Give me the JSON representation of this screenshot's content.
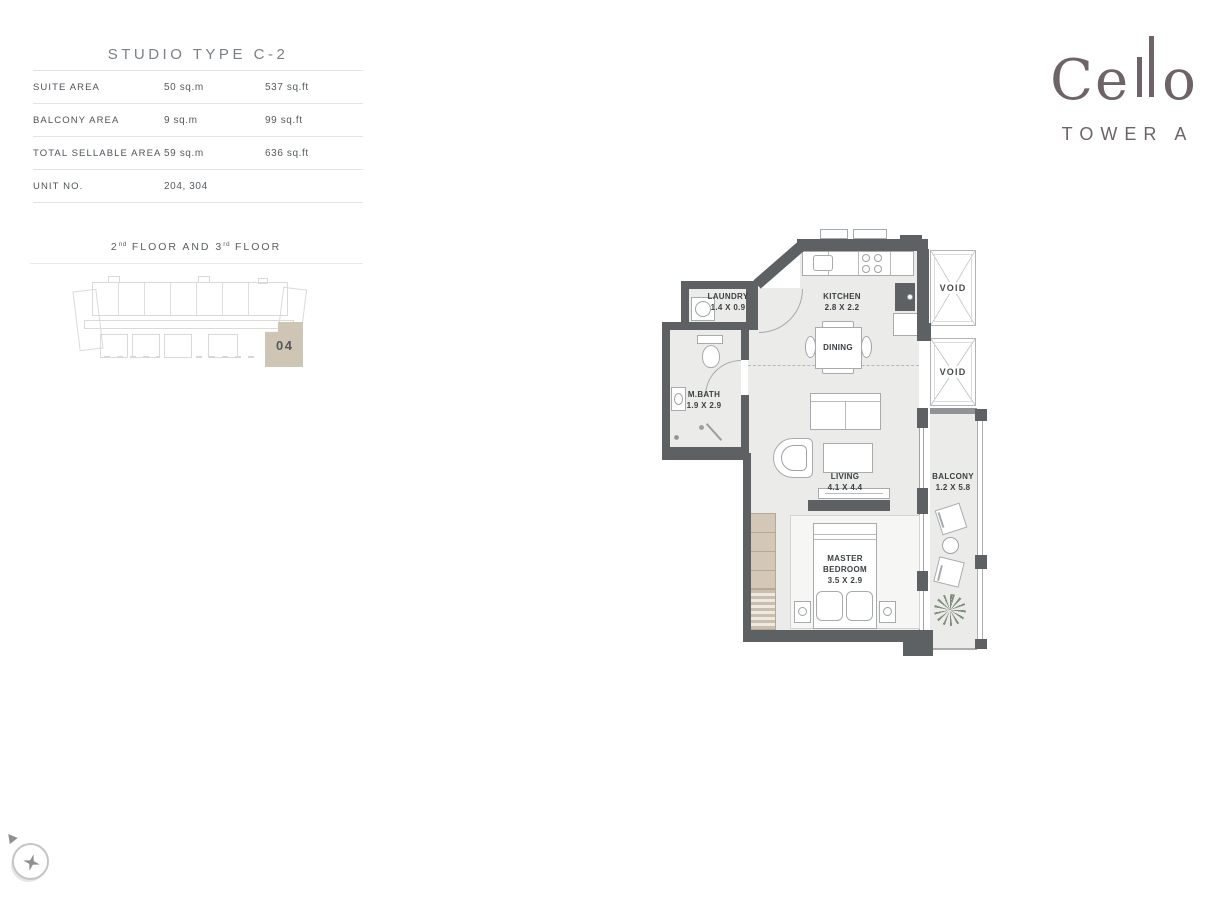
{
  "unit_info": {
    "title": "STUDIO TYPE C-2",
    "rows": [
      {
        "label": "SUITE AREA",
        "metric": "50 sq.m",
        "imperial": "537 sq.ft"
      },
      {
        "label": "BALCONY AREA",
        "metric": "9 sq.m",
        "imperial": "99 sq.ft"
      },
      {
        "label": "TOTAL SELLABLE AREA",
        "metric": "59 sq.m",
        "imperial": "636 sq.ft"
      },
      {
        "label": "UNIT NO.",
        "metric": "204, 304",
        "imperial": ""
      }
    ]
  },
  "floor_locator": {
    "label": {
      "n1": "2",
      "s1": "nd",
      "mid": " FLOOR AND 3",
      "s2": "rd",
      "end": " FLOOR"
    },
    "unit_number": "04"
  },
  "brand": {
    "logo_start": "Ce",
    "logo_end": "o",
    "tower": "TOWER A"
  },
  "floor_plan": {
    "laundry": {
      "name": "LAUNDRY",
      "dims": "1.4 X 0.9"
    },
    "kitchen": {
      "name": "KITCHEN",
      "dims": "2.8 X 2.2"
    },
    "dining": {
      "name": "DINING"
    },
    "mbath": {
      "name": "M.BATH",
      "dims": "1.9 X 2.9"
    },
    "living": {
      "name": "LIVING",
      "dims": "4.1 X 4.4"
    },
    "master": {
      "name1": "MASTER",
      "name2": "BEDROOM",
      "dims": "3.5 X 2.9"
    },
    "balcony": {
      "name": "BALCONY",
      "dims": "1.2 X 5.8"
    },
    "void_top": {
      "name": "VOID"
    },
    "void_bottom": {
      "name": "VOID"
    }
  },
  "colors": {
    "wall": "#5d6164",
    "floor": "#ebebe9",
    "highlight_beige": "#cfc5b5",
    "brand": "#6d6368"
  }
}
